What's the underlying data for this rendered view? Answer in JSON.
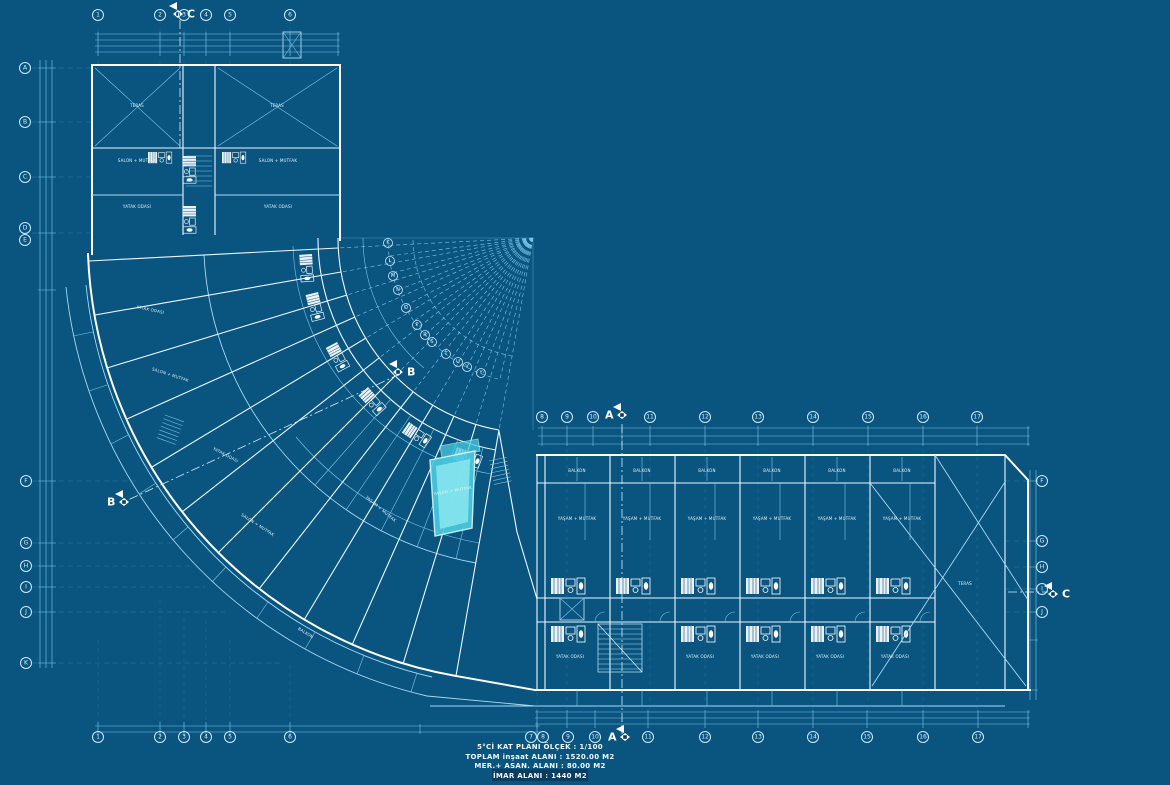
{
  "title_block": {
    "line1": "5°Cİ  KAT  PLANI   ÖLÇEK : 1/100",
    "line2": "TOPLAM inşaat ALANI : 1520.00 M2",
    "line3": "MER.+ ASAN. ALANI : 80.00 M2",
    "line4": "İMAR  ALANI : 1440 M2"
  },
  "section_markers": {
    "a": "A",
    "b": "B",
    "c": "C"
  },
  "grid": {
    "bottom_numbers": [
      "1",
      "2",
      "3",
      "4",
      "5",
      "6",
      "7",
      "8",
      "9",
      "10",
      "11",
      "12",
      "13",
      "14",
      "15",
      "16",
      "17"
    ],
    "top_left_numbers": [
      "1",
      "2",
      "3",
      "4",
      "5",
      "6"
    ],
    "top_right_numbers": [
      "8",
      "9",
      "10",
      "11",
      "12",
      "13",
      "14",
      "15",
      "16",
      "17"
    ],
    "left_letters": [
      "A",
      "B",
      "C",
      "D",
      "E"
    ],
    "left_lower_letters": [
      "F",
      "G",
      "H",
      "I",
      "J",
      "K"
    ],
    "right_letters": [
      "F",
      "G",
      "H",
      "I",
      "J"
    ],
    "arc_letters": [
      "K",
      "L",
      "M",
      "N",
      "O",
      "P",
      "R",
      "S",
      "T",
      "U",
      "V",
      "Y"
    ]
  },
  "rooms": {
    "yasam_mutfak": "YAŞAM + MUTFAK",
    "salon_mutfak": "SALON + MUTFAK",
    "yatak_odasi": "YATAK ODASI",
    "balkon": "BALKON",
    "teras": "TERAS"
  },
  "highlight": {
    "label": "YAŞAM + MUTFAK",
    "color": "#49cadf"
  },
  "colors": {
    "background": "#0a5580",
    "walls": "#ffffff",
    "thin_lines": "#7cc4ea",
    "highlight": "#49cadf",
    "dark_band": "#0b3c60"
  }
}
